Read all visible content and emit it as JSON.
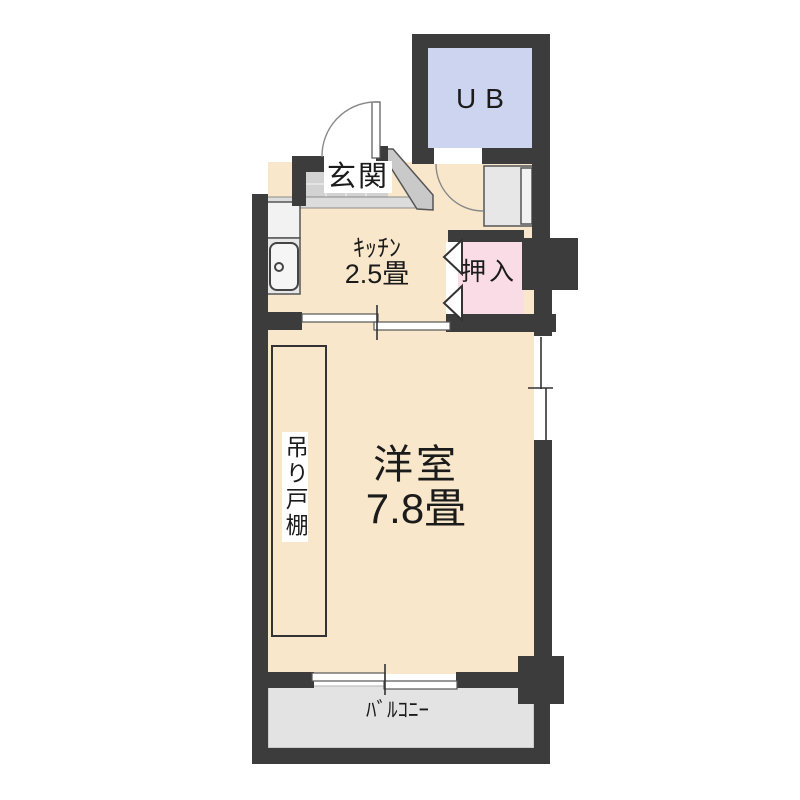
{
  "title": "floor-plan",
  "colors": {
    "wall": "#3c3c3c",
    "floor": "#f8e7cb",
    "unit_bath": "#cdd4f0",
    "closet": "#f9dce6",
    "entrance_tile": "#d2d2d2",
    "balcony": "#e3e3e3",
    "text": "#1b1b1b"
  },
  "rooms": {
    "unit_bath": {
      "label": "UB"
    },
    "entrance": {
      "label": "玄関"
    },
    "kitchen": {
      "label": "ｷｯﾁﾝ",
      "size": "2.5畳"
    },
    "closet": {
      "label": "押入"
    },
    "western_room": {
      "label": "洋室",
      "size": "7.8畳"
    },
    "hanging_cupboard": {
      "label": "吊り戸棚"
    },
    "balcony": {
      "label": "ﾊﾞﾙｺﾆｰ"
    }
  }
}
